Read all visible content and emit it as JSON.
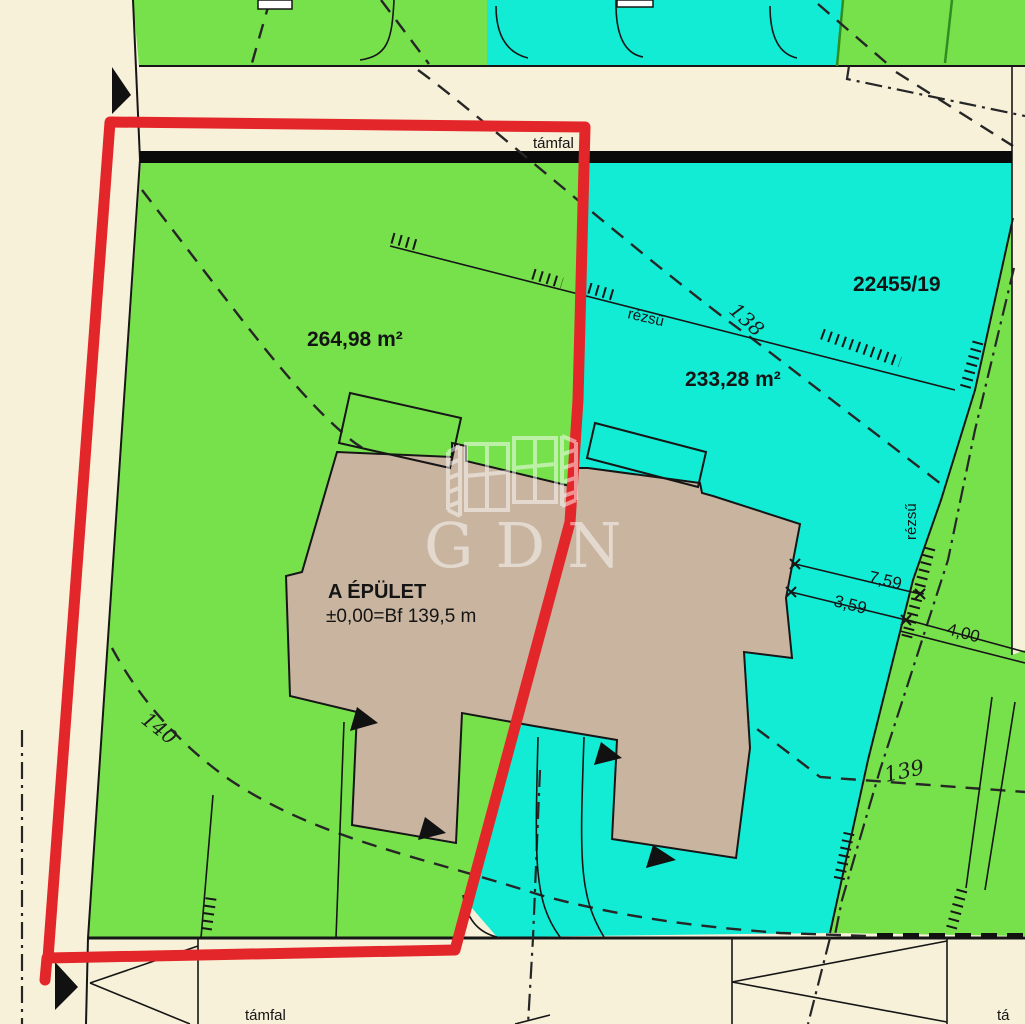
{
  "colors": {
    "background": "#f8f1da",
    "green": "#77e14c",
    "cyan": "#12ecd5",
    "building": "#c8b49f",
    "red": "#e32629",
    "line": "#161616",
    "watermark": "#ffffff"
  },
  "labels": {
    "tamfal_top": "támfal",
    "tamfal_bottom": "támfal",
    "tamfal_right_partial": "tá",
    "parcel_number": "22455/19",
    "area_green": "264,98 m²",
    "area_cyan": "233,28 m²",
    "building_name": "A ÉPÜLET",
    "building_elevation": "±0,00=Bf 139,5 m",
    "slope_top": "rézsű",
    "slope_right": "rézsű",
    "contour_138": "138",
    "contour_139": "139",
    "contour_140": "140",
    "dim_1": "7,59",
    "dim_2": "3,59",
    "dim_3": "4,00",
    "watermark": "GDN"
  }
}
